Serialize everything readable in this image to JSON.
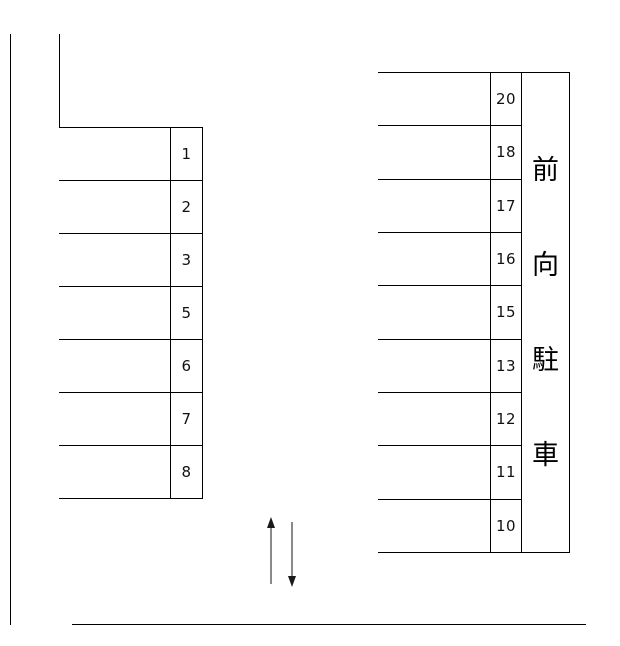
{
  "diagram": {
    "background_color": "#ffffff",
    "line_color": "#000000",
    "left_block": {
      "spaces": [
        "1",
        "2",
        "3",
        "5",
        "6",
        "7",
        "8"
      ]
    },
    "right_block": {
      "spaces": [
        "20",
        "18",
        "17",
        "16",
        "15",
        "13",
        "12",
        "11",
        "10"
      ]
    },
    "side_label": {
      "text": "前向駐車",
      "chars": [
        "前",
        "向",
        "駐",
        "車"
      ]
    },
    "arrows": {
      "up_icon": "arrow-up",
      "down_icon": "arrow-down",
      "shaft_color": "#8a8a8a",
      "head_color": "#1a1a1a"
    }
  }
}
